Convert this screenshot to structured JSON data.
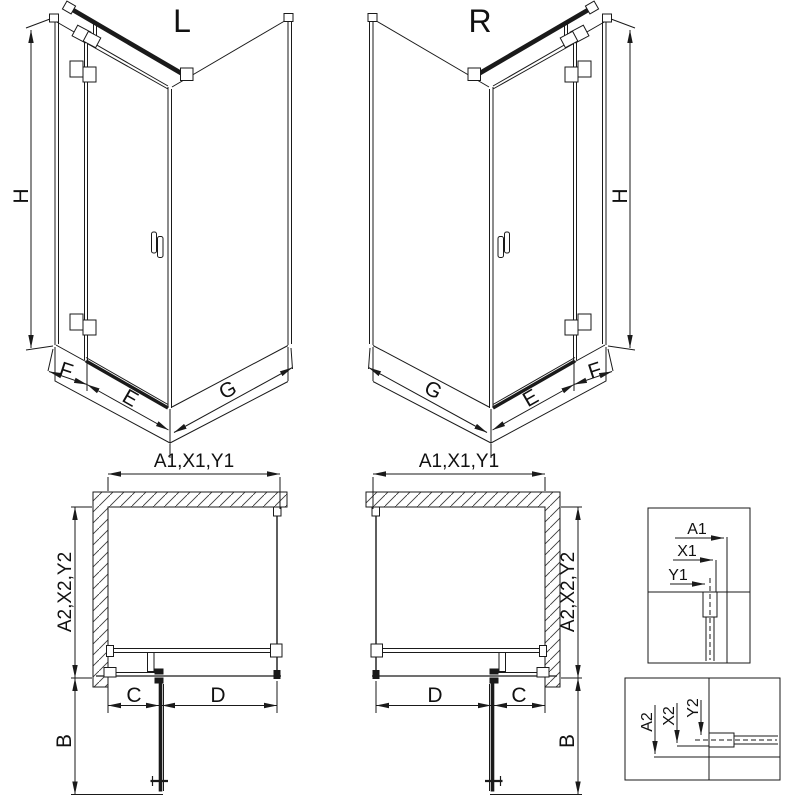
{
  "diagram": {
    "background_color": "#ffffff",
    "line_color": "#1a1a1a",
    "iso_left": {
      "title": "L",
      "dim_height": "H",
      "dim_fixed_width": "F",
      "dim_door_width": "E",
      "dim_side_width": "G"
    },
    "iso_right": {
      "title": "R",
      "dim_height": "H",
      "dim_fixed_width": "F",
      "dim_door_width": "E",
      "dim_side_width": "G"
    },
    "plan_left": {
      "dim_top": "A1,X1,Y1",
      "dim_side": "A2,X2,Y2",
      "dim_fixed": "C",
      "dim_door": "D",
      "dim_swing": "B"
    },
    "plan_right": {
      "dim_top": "A1,X1,Y1",
      "dim_side": "A2,X2,Y2",
      "dim_fixed": "C",
      "dim_door": "D",
      "dim_swing": "B"
    },
    "detail_wall_profile": {
      "dim_a": "A1",
      "dim_x": "X1",
      "dim_y": "Y1"
    },
    "detail_floor_profile": {
      "dim_a": "A2",
      "dim_x": "X2",
      "dim_y": "Y2"
    }
  }
}
